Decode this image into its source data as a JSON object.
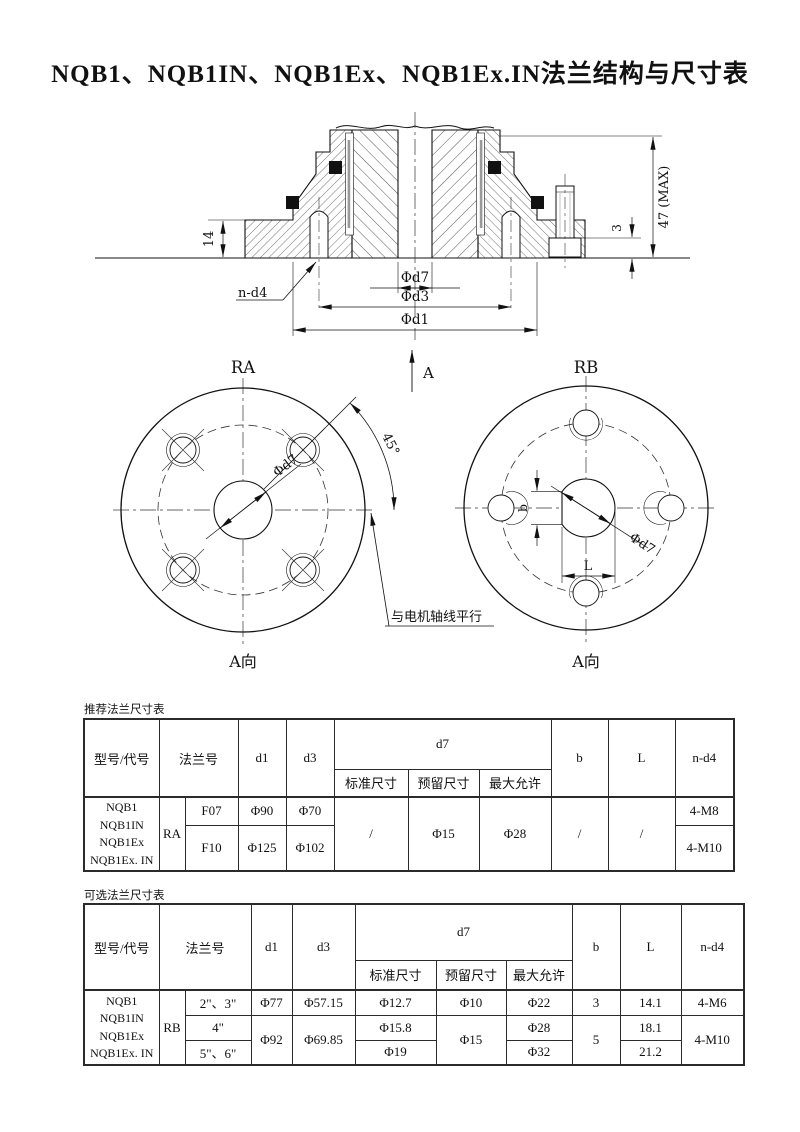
{
  "page": {
    "title": "NQB1、NQB1IN、NQB1Ex、NQB1Ex.IN法兰结构与尺寸表"
  },
  "drawing": {
    "section": {
      "dim_plate_height": "14",
      "dim_total_height": "47 (MAX)",
      "dim_nut_height": "3",
      "bolt_callout": "n-d4",
      "dim_d7": "Φd7",
      "dim_d3": "Φd3",
      "dim_d1": "Φd1",
      "view_arrow": "A"
    },
    "view_ra": {
      "label": "RA",
      "angle": "45°",
      "dim_d7": "Φd7",
      "note": "与电机轴线平行",
      "direction": "A向"
    },
    "view_rb": {
      "label": "RB",
      "dim_b": "b",
      "dim_l": "L",
      "dim_d7": "Φd7",
      "direction": "A向"
    }
  },
  "tables": {
    "recommended": {
      "caption": "推荐法兰尺寸表",
      "headers": {
        "model": "型号/代号",
        "flange": "法兰号",
        "d1": "d1",
        "d3": "d3",
        "d7": "d7",
        "d7_std": "标准尺寸",
        "d7_reserved": "预留尺寸",
        "d7_max": "最大允许",
        "b": "b",
        "l": "L",
        "n_d4": "n-d4"
      },
      "models": [
        "NQB1",
        "NQB1IN",
        "NQB1Ex",
        "NQB1Ex. IN"
      ],
      "group": "RA",
      "rows": [
        {
          "flange": "F07",
          "d1": "Φ90",
          "d3": "Φ70",
          "n_d4": "4-M8"
        },
        {
          "flange": "F10",
          "d1": "Φ125",
          "d3": "Φ102",
          "n_d4": "4-M10"
        }
      ],
      "merged": {
        "d7_std": "/",
        "d7_reserved": "Φ15",
        "d7_max": "Φ28",
        "b": "/",
        "l": "/"
      }
    },
    "optional": {
      "caption": "可选法兰尺寸表",
      "headers": {
        "model": "型号/代号",
        "flange": "法兰号",
        "d1": "d1",
        "d3": "d3",
        "d7": "d7",
        "d7_std": "标准尺寸",
        "d7_reserved": "预留尺寸",
        "d7_max": "最大允许",
        "b": "b",
        "l": "L",
        "n_d4": "n-d4"
      },
      "models": [
        "NQB1",
        "NQB1IN",
        "NQB1Ex",
        "NQB1Ex. IN"
      ],
      "group": "RB",
      "rows": [
        {
          "flange": "2\"、3\"",
          "d1": "Φ77",
          "d3": "Φ57.15",
          "d7_std": "Φ12.7",
          "d7_reserved": "Φ10",
          "d7_max": "Φ22",
          "b": "3",
          "l": "14.1",
          "n_d4": "4-M6"
        },
        {
          "flange": "4\"",
          "d1": "Φ92",
          "d3": "Φ69.85",
          "d7_std": "Φ15.8",
          "d7_reserved": "Φ15",
          "d7_max": "Φ28",
          "b": "5",
          "l": "18.1",
          "n_d4": "4-M10"
        },
        {
          "flange": "5\"、6\"",
          "d7_std": "Φ19",
          "d7_max": "Φ32",
          "l": "21.2"
        }
      ]
    }
  }
}
